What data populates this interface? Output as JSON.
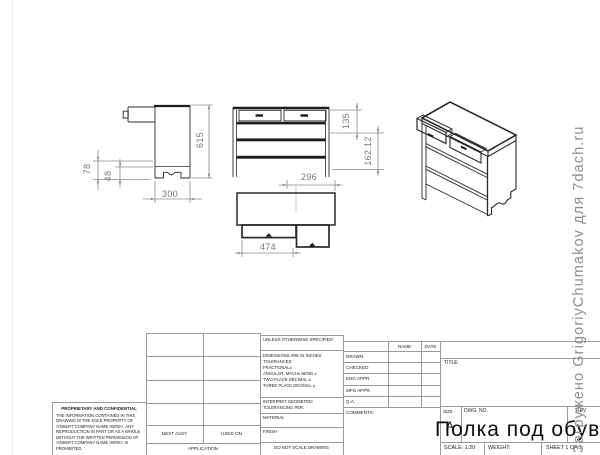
{
  "watermark": {
    "text": "Загружено GrigoriyChumakov для 7dach.ru"
  },
  "dimensions": {
    "side_height": "615",
    "side_leg": "78",
    "side_arch": "48",
    "side_depth": "300",
    "front_upper": "135",
    "front_lower": "162.12",
    "front_width": "296",
    "top_drawer": "474"
  },
  "title_block": {
    "spec_header": "UNLESS OTHERWISE SPECIFIED:",
    "spec_lines": "DIMENSIONS ARE IN INCHES\nTOLERANCES:\nFRACTIONAL±\nANGULAR: MACH±   BEND ±\nTWO PLACE DECIMAL   ±\nTHREE PLACE DECIMAL ±",
    "interpret": "INTERPRET GEOMETRIC\nTOLERANCING PER:",
    "material_label": "MATERIAL",
    "finish_label": "FINISH",
    "do_not_scale": "DO NOT SCALE DRAWING",
    "name_header": "NAME",
    "date_header": "DATE",
    "row_drawn": "DRAWN",
    "row_checked": "CHECKED",
    "row_eng_appr": "ENG APPR.",
    "row_mfg_appr": "MFG APPR.",
    "row_qa": "Q.A.",
    "row_comments": "COMMENTS:",
    "proprietary_header": "PROPRIETARY AND CONFIDENTIAL",
    "proprietary_body": "THE INFORMATION CONTAINED IN THIS DRAWING IS THE SOLE PROPERTY OF <INSERT COMPANY NAME HERE>. ANY REPRODUCTION IN PART OR AS A WHOLE WITHOUT THE WRITTEN PERMISSION OF <INSERT COMPANY NAME HERE> IS PROHIBITED.",
    "next_assy": "NEXT ASSY",
    "used_on": "USED ON",
    "application_label": "APPLICATION",
    "title_label": "TITLE:",
    "size_label": "SIZE",
    "size_value": "A",
    "dwg_no_label": "DWG. NO.",
    "rev_label": "REV",
    "drawing_title": "Полка под обувь",
    "scale_label": "SCALE: 1:20",
    "weight_label": "WEIGHT:",
    "sheet_label": "SHEET 1 OF 1"
  }
}
